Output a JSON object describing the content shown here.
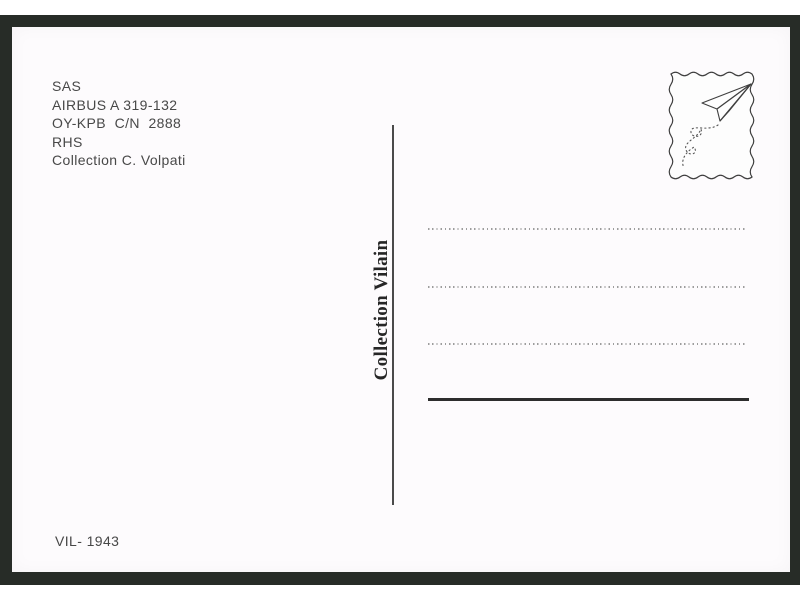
{
  "postcard": {
    "caption": {
      "lines": [
        "SAS",
        "AIRBUS A 319-132",
        "OY-KPB  C/N  2888",
        "RHS",
        "Collection C. Volpati"
      ]
    },
    "publisher_label": "Collection Vilain",
    "catalog_number": "VIL- 1943",
    "address_area": {
      "dotted_lines_count": 3,
      "has_solid_signature_line": true
    },
    "stamp": {
      "icons": [
        "postage-stamp-frame-icon",
        "paper-plane-icon",
        "dotted-flight-trail-icon"
      ]
    },
    "colors": {
      "frame": "#272c27",
      "card": "#fdfbfd",
      "caption_text": "#484848",
      "publisher_text": "#262626",
      "divider": "#4a4a4a",
      "dotted_line": "#9d9d9d",
      "signature_line": "#2d2d2d",
      "stamp_ink": "#3f3f3f"
    }
  }
}
